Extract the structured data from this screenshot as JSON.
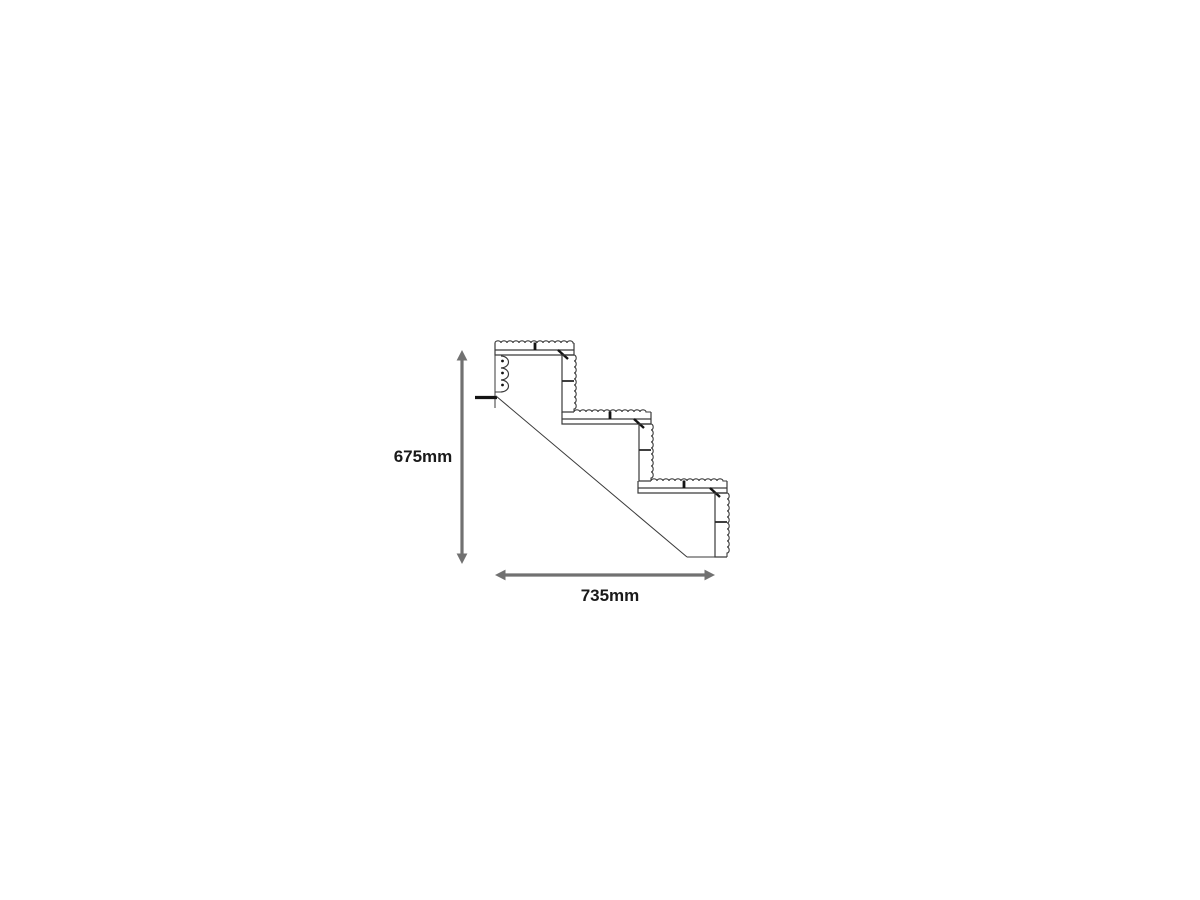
{
  "diagram": {
    "type": "stair-cross-section",
    "steps": 3,
    "boards_per_tread": 2,
    "boards_per_riser": 2,
    "dimension_labels": {
      "height": "675mm",
      "width": "735mm"
    },
    "colors": {
      "outline": "#3a3a3a",
      "joints": "#141414",
      "dimension_arrow": "#717171",
      "label_text": "#1a1a1a",
      "background": "#ffffff"
    }
  }
}
